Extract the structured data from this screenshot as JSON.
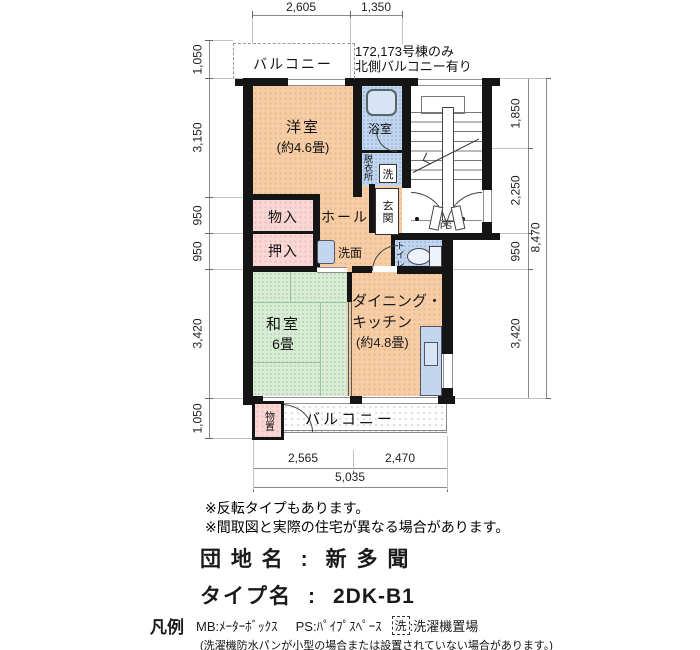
{
  "plan": {
    "balcony_top_label": "バルコニー",
    "annotation": [
      "172,173号棟のみ",
      "北側バルコニー有り"
    ],
    "rooms": {
      "youshitsu_l1": "洋室",
      "youshitsu_l2": "(約4.6畳)",
      "yokushitsu": "浴室",
      "datsuiijo": "脱衣所",
      "laundry_symbol": "洗",
      "genkan": "玄関",
      "hall": "ホール",
      "monoire": "物入",
      "oshiire": "押入",
      "senmen": "洗面",
      "toilet": "トイレ",
      "washitsu_l1": "和室",
      "washitsu_l2": "6畳",
      "dk_l1": "ダイニング・",
      "dk_l2": "キッチン",
      "dk_l3": "(約4.8畳)",
      "monooki": "物置",
      "balcony_bottom_label": "バルコニー",
      "ps": "PS"
    },
    "dims": {
      "top": [
        "2,605",
        "1,350"
      ],
      "left": [
        "1,050",
        "3,150",
        "950",
        "950",
        "3,420",
        "1,050"
      ],
      "right": [
        "1,850",
        "2,250",
        "950",
        "3,420"
      ],
      "right_total": "8,470",
      "bottom": [
        "2,565",
        "2,470"
      ],
      "bottom_total": "5,035"
    }
  },
  "notes": [
    "※反転タイプもあります。",
    "※間取図と実際の住宅が異なる場合があります。"
  ],
  "title": {
    "row1_label": "団 地 名",
    "row1_sep": ":",
    "row1_value": "新 多 聞",
    "row2_label": "タイプ名",
    "row2_sep": ":",
    "row2_value": "2DK-B1"
  },
  "legend": {
    "heading": "凡例",
    "mb": "MB:ﾒｰﾀｰﾎﾞｯｸｽ",
    "ps": "PS:ﾊﾟｲﾌﾟｽﾍﾟｰｽ",
    "wash_symbol": "洗",
    "wash_label": ":洗濯機置場",
    "note": "(洗濯機防水パンが小型の場合または設置されていない場合があります。)"
  },
  "colors": {
    "room_orange": "#f6cda6",
    "closet_pink": "#f8d7d4",
    "tatami_green": "#d9ecd6",
    "water_blue": "#c2d6ee",
    "wall_black": "#151515"
  }
}
